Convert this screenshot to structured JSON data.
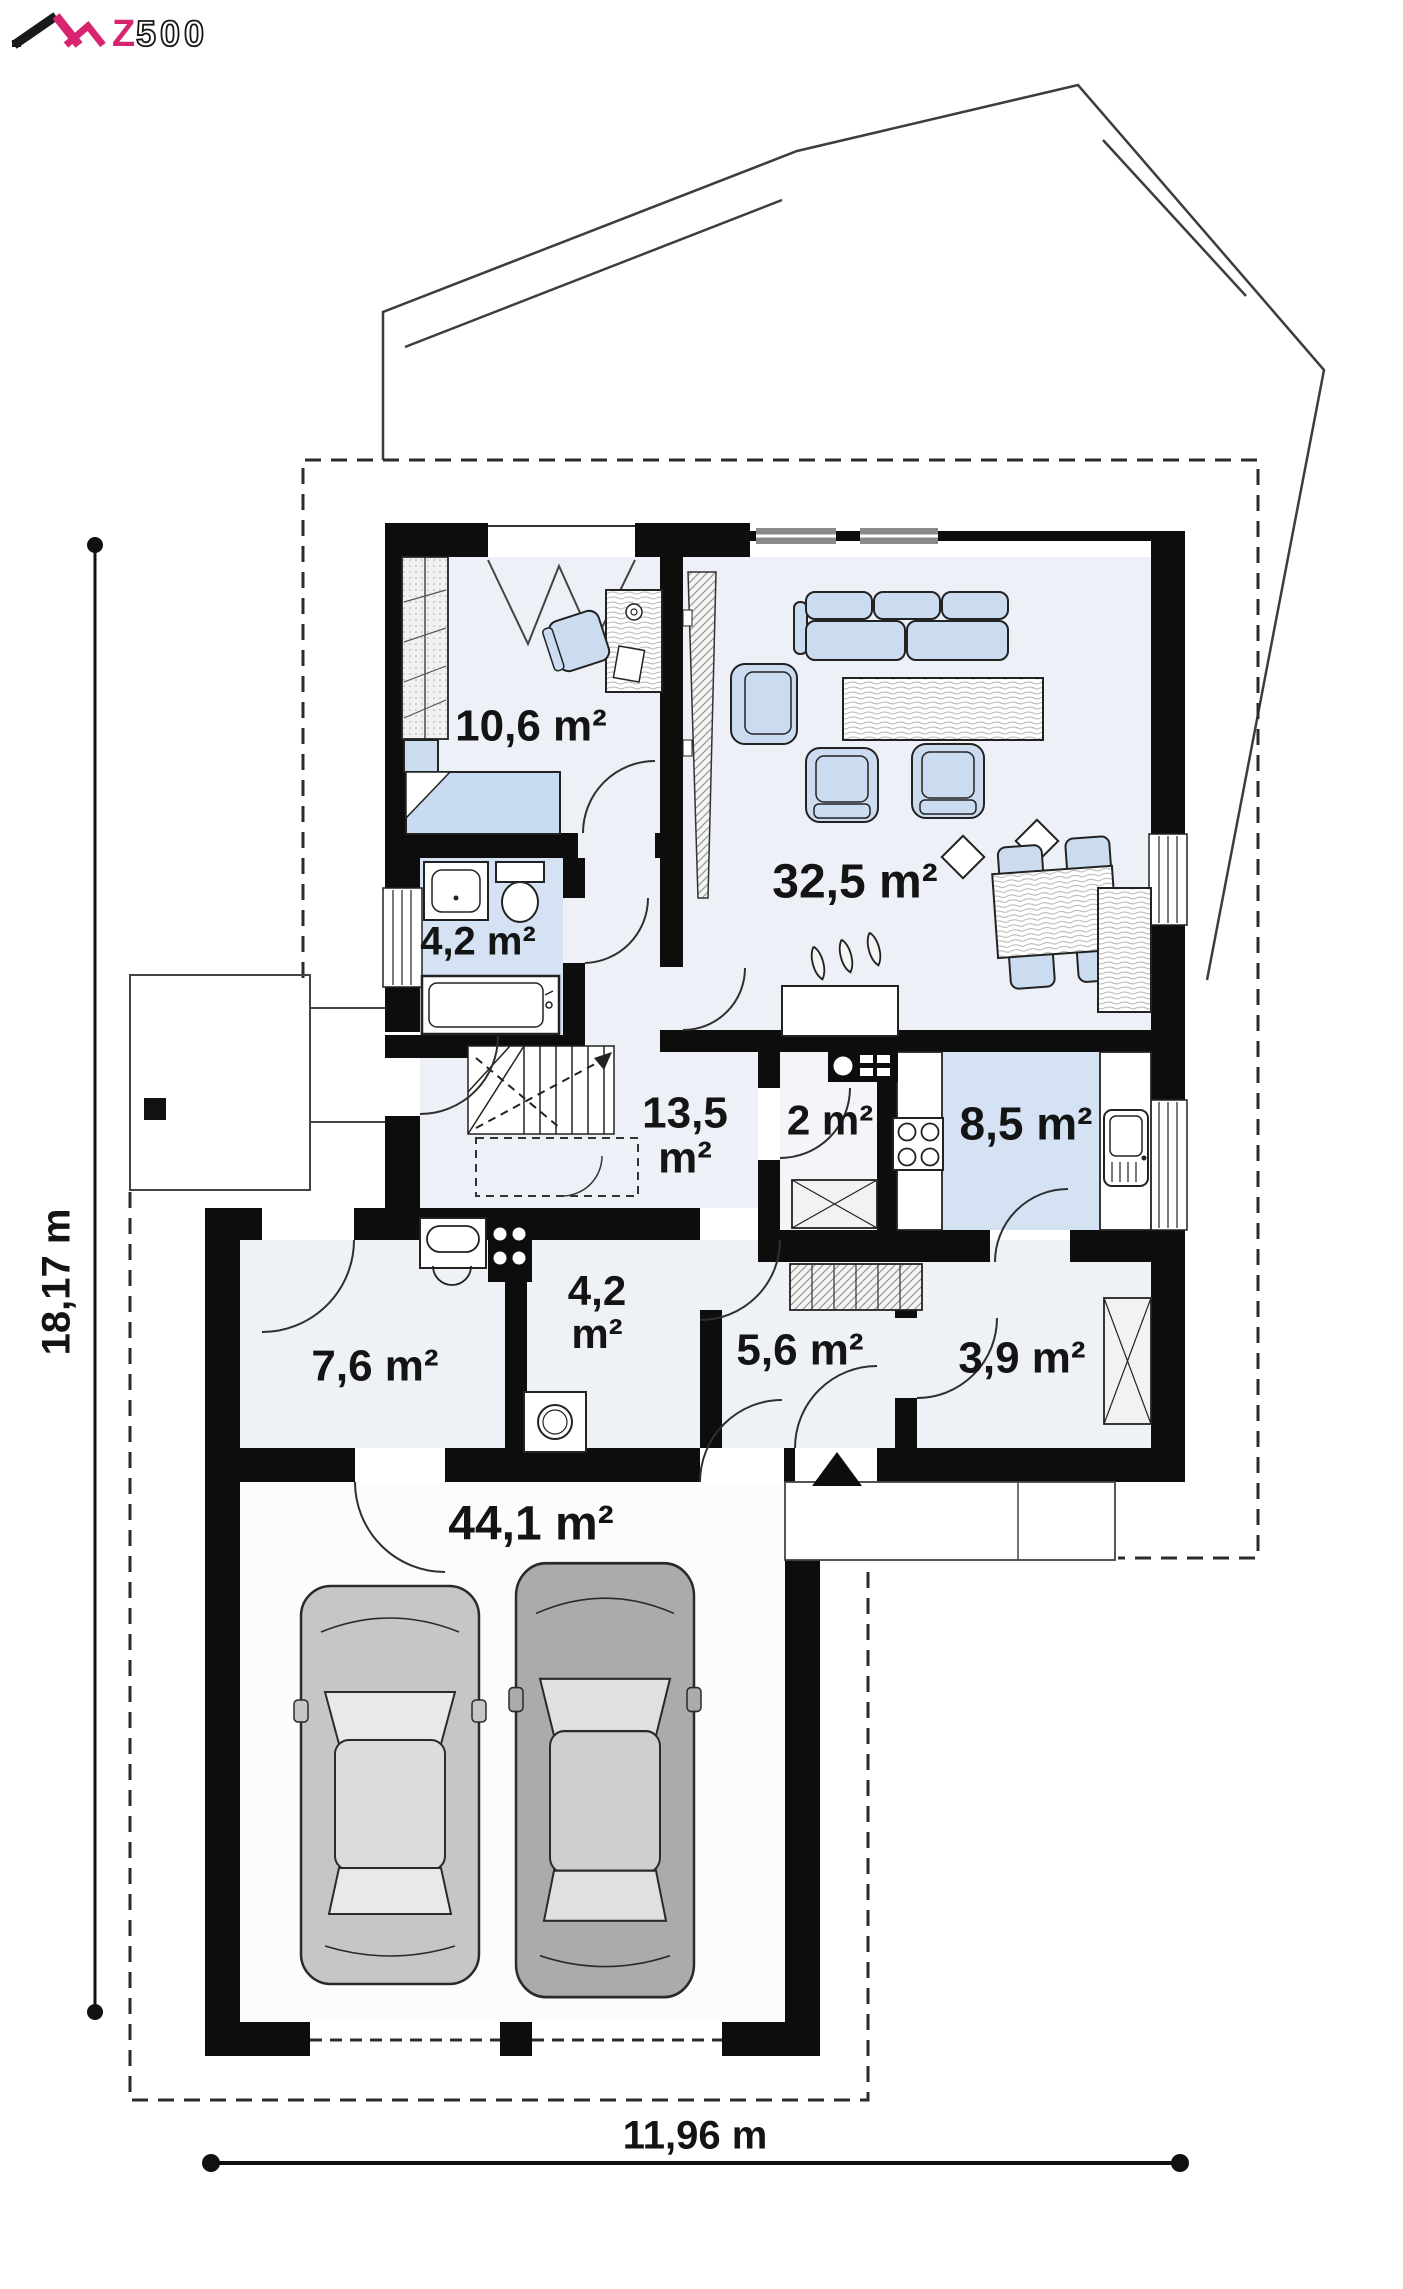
{
  "brand": {
    "logo_z": "Z",
    "logo_500": "500"
  },
  "rooms": [
    {
      "id": "bedroom",
      "area": "10,6 m²"
    },
    {
      "id": "living-room",
      "area": "32,5 m²"
    },
    {
      "id": "bathroom",
      "area": "4,2 m²"
    },
    {
      "id": "hall-stairs",
      "area": "13,5 m²"
    },
    {
      "id": "wc-pantry",
      "area": "2 m²"
    },
    {
      "id": "kitchen",
      "area": "8,5 m²"
    },
    {
      "id": "utility-room",
      "area": "7,6 m²"
    },
    {
      "id": "laundry",
      "area": "4,2 m²"
    },
    {
      "id": "corridor",
      "area": "5,6 m²"
    },
    {
      "id": "entry-hall",
      "area": "3,9 m²"
    },
    {
      "id": "garage",
      "area": "44,1 m²"
    }
  ],
  "dimensions": {
    "height": "18,17 m",
    "width": "11,96 m"
  },
  "colors": {
    "wall": "#0d0d0d",
    "room_fill": "#edf1f7",
    "accent_room_fill": "#d4e2f4",
    "furniture_fill": "#cbdcf1",
    "logo_accent": "#d6246e"
  }
}
